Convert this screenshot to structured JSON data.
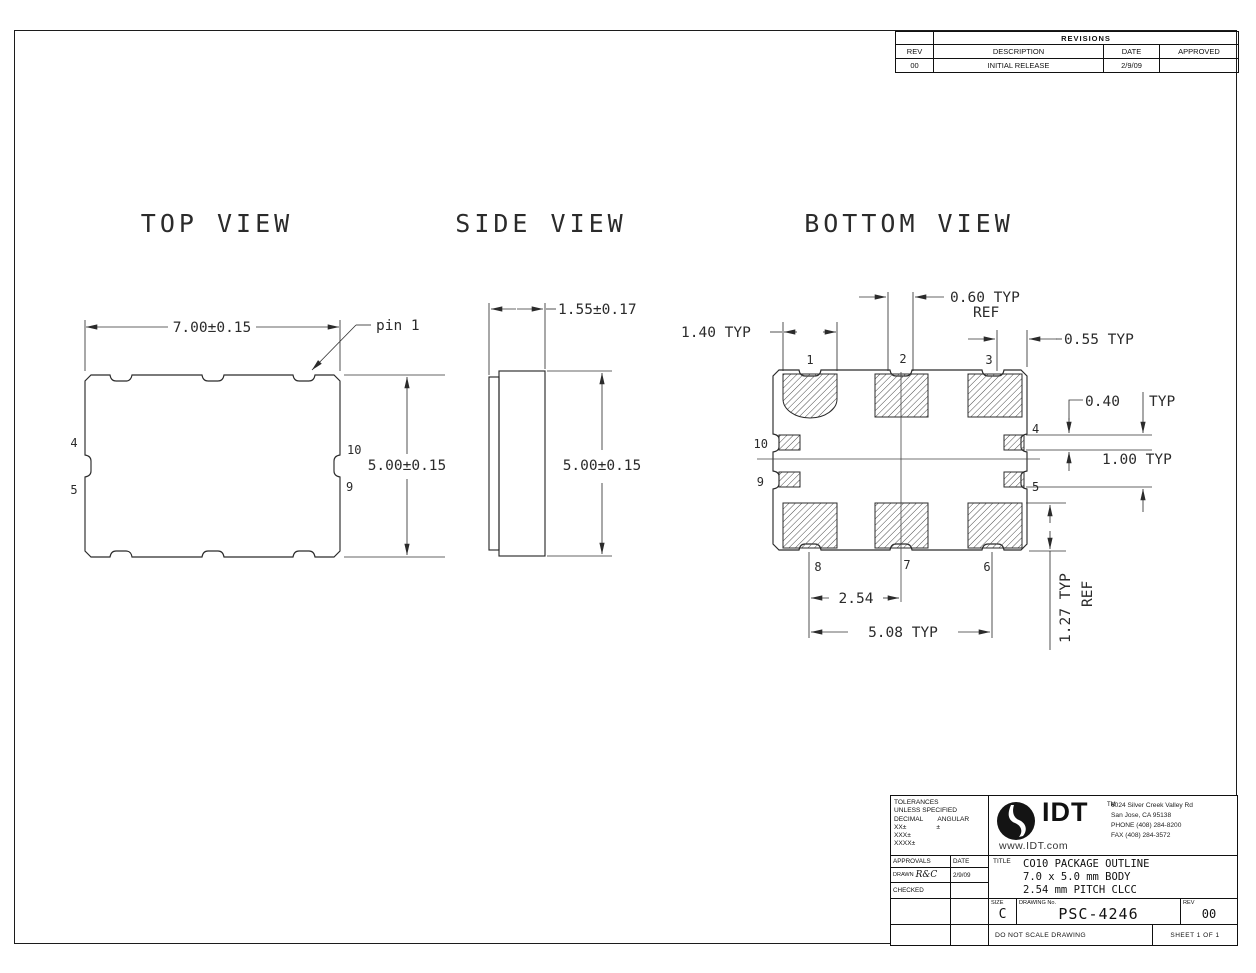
{
  "revisions": {
    "title": "REVISIONS",
    "col_rev": "REV",
    "col_desc": "DESCRIPTION",
    "col_date": "DATE",
    "col_appr": "APPROVED",
    "row": {
      "rev": "00",
      "desc": "INITIAL RELEASE",
      "date": "2/9/09",
      "appr": ""
    }
  },
  "top_view": {
    "title": "TOP VIEW",
    "dim_width": "7.00±0.15",
    "dim_height": "5.00±0.15",
    "pin1": "pin 1",
    "pin4": "4",
    "pin5": "5",
    "pin10": "10",
    "pin9": "9"
  },
  "side_view": {
    "title": "SIDE VIEW",
    "dim_thickness": "1.55±0.17",
    "dim_height": "5.00±0.15"
  },
  "bottom_view": {
    "title": "BOTTOM VIEW",
    "dim_pad_width": "1.40 TYP",
    "dim_gap": "0.60 TYP",
    "dim_gap_ref": "REF",
    "dim_corner": "0.55 TYP",
    "dim_pad_height": "0.40",
    "dim_pad_height_typ": "TYP",
    "dim_side_pitch": "1.00 TYP",
    "dim_row": "1.27 TYP",
    "dim_row_ref": "REF",
    "dim_pitch": "2.54",
    "dim_span": "5.08 TYP",
    "pin1": "1",
    "pin2": "2",
    "pin3": "3",
    "pin4": "4",
    "pin5": "5",
    "pin6": "6",
    "pin7": "7",
    "pin8": "8",
    "pin9": "9",
    "pin10": "10"
  },
  "title_block": {
    "tol_line1": "TOLERANCES",
    "tol_line2": "UNLESS SPECIFIED",
    "tol_decimal": "DECIMAL",
    "tol_angular": "ANGULAR",
    "tol_xx": "XX±",
    "tol_ang_pm": "±",
    "tol_xxx": "XXX±",
    "tol_xxxx": "XXXX±",
    "approvals": "APPROVALS",
    "date": "DATE",
    "drawn": "DRAWN",
    "drawn_sig": "R&C",
    "drawn_date": "2/9/09",
    "checked": "CHECKED",
    "logo": "IDT",
    "logo_tm": "TM",
    "website": "www.IDT.com",
    "addr1": "6024 Silver Creek Valley Rd",
    "addr2": "San Jose, CA 95138",
    "addr3": "PHONE (408) 284-8200",
    "addr4": "FAX (408) 284-3572",
    "title_label": "TITLE",
    "title1": "CO10 PACKAGE OUTLINE",
    "title2": "7.0 x 5.0 mm BODY",
    "title3": "2.54 mm PITCH CLCC",
    "size_label": "SIZE",
    "size": "C",
    "dwg_label": "DRAWING No.",
    "dwg_no": "PSC-4246",
    "rev_label": "REV",
    "rev": "00",
    "note": "DO NOT SCALE DRAWING",
    "sheet": "SHEET 1 OF 1"
  }
}
